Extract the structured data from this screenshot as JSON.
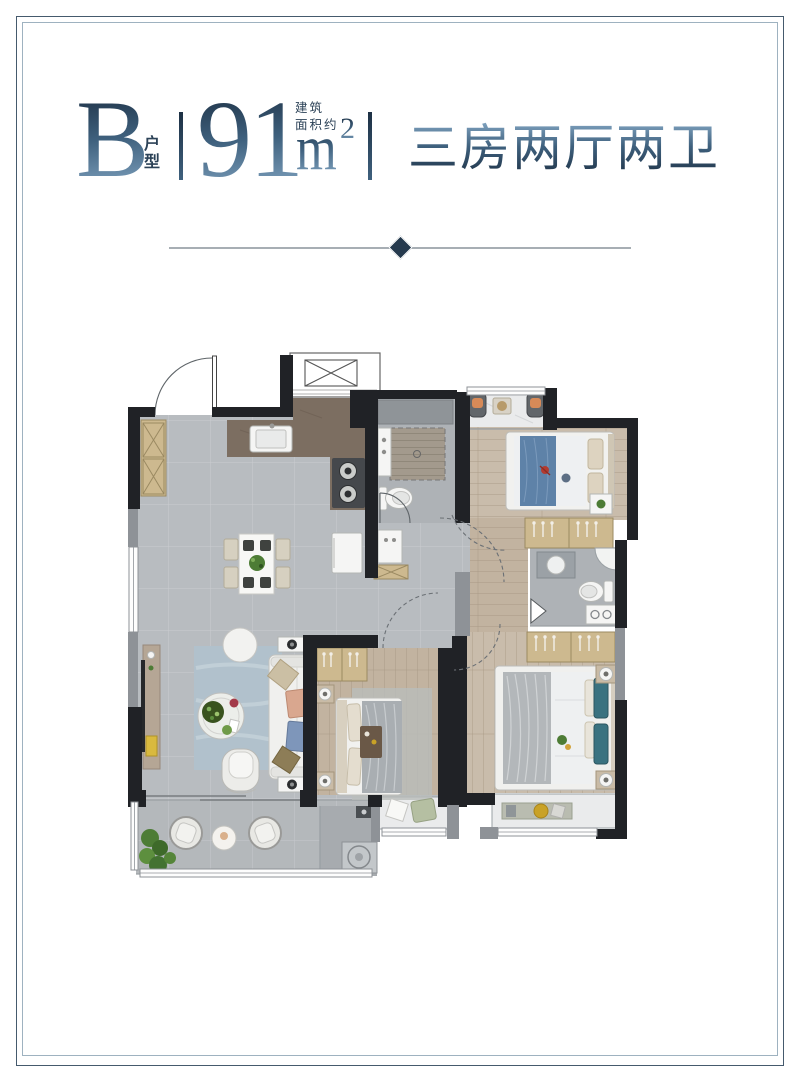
{
  "header": {
    "unit_letter": "B",
    "unit_label": "户型",
    "area_value": "91",
    "area_unit": "m",
    "area_superscript": "2",
    "area_note_line1": "建筑",
    "area_note_line2": "面积约",
    "layout_description": "三房两厅两卫"
  },
  "divider": {
    "style": "horizontal-line-with-center-diamond"
  },
  "floor_plan": {
    "type": "residential-unit-top-view-render",
    "rooms": [
      "entry",
      "kitchen",
      "dining-area",
      "living-room",
      "bath-1",
      "bath-2",
      "bedroom-1",
      "bedroom-2",
      "master-bedroom",
      "corridor",
      "north-balcony",
      "south-balcony",
      "laundry-nook",
      "utility-shaft"
    ],
    "text_labels": []
  },
  "colors": {
    "accent_dark": "#1d3044",
    "accent_mid": "#3f617e",
    "accent_light": "#85a8c5",
    "subtext": "#2c4257",
    "divider_line": "#a7aeb4",
    "diamond": "#263a4e",
    "frame_outer": "#455a6d",
    "frame_inner": "#9eb2c0",
    "wall_black": "#202226",
    "wall_gray": "#8e9297",
    "floor_tile": "#b8bcc0",
    "tile_line": "#caccd0",
    "bath_tile": "#aeb2b6",
    "wood_light": "#c9bcab",
    "wood_mid": "#c2b3a0",
    "wood_line": "#a3947f",
    "kitchen_brown": "#7c6e61",
    "marble": "#eaebec",
    "fixture_white": "#f5f5f4",
    "stove_dark": "#45484c",
    "rug_blue": "#b1c1cc",
    "bed_blue": "#5e82a8",
    "duvet_gray": "#a9aeb2",
    "pillow_teal": "#3a7280",
    "cabinet_wood": "#cdb98f",
    "greenery": "#4d7c35",
    "accent_orange": "#d78a58",
    "accent_yellow": "#d9b93e"
  }
}
